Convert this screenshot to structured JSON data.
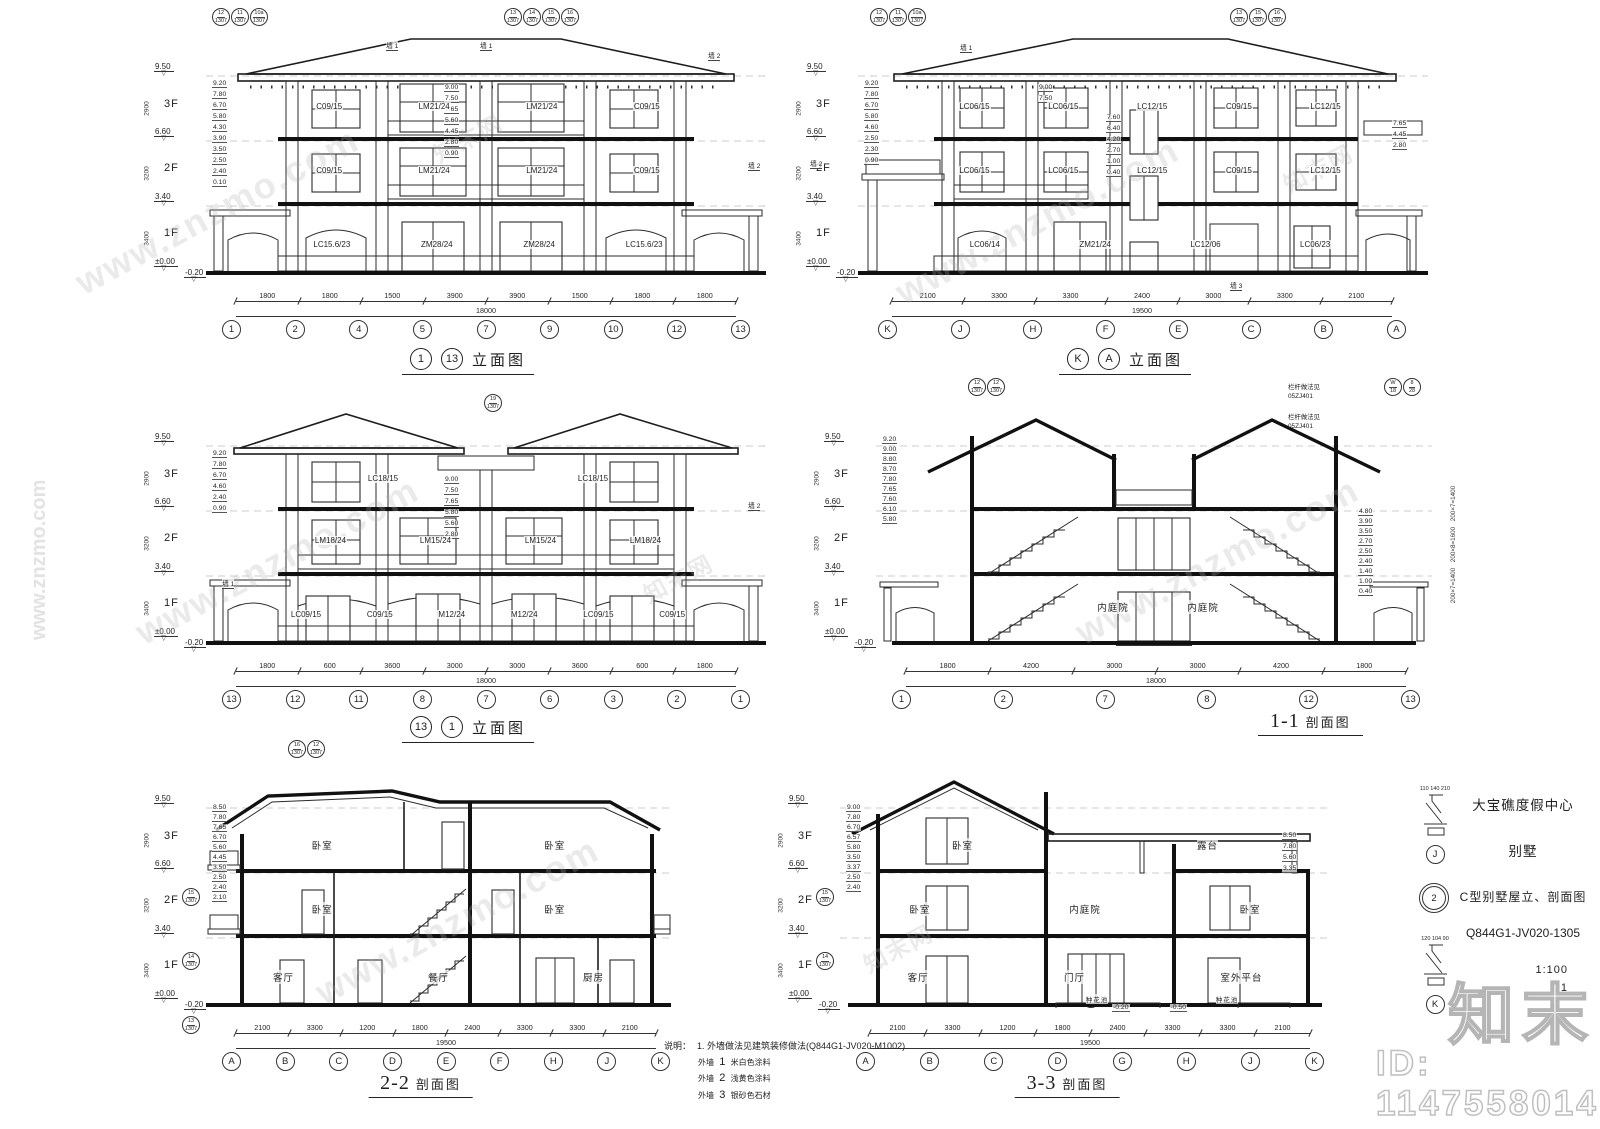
{
  "page": {
    "bg": "#ffffff",
    "ink": "#1f1f1f",
    "watermark": "www.znzmo.com",
    "watermark_cn": "知末网",
    "logo": "知末",
    "id_label": "ID: 1147558014"
  },
  "titleblock": {
    "project": "大宝礁度假中心",
    "building": "别墅",
    "drawing_title": "C型别墅屋立、剖面图",
    "drawing_no": "Q844G1-JV020-1305",
    "scale": "1:100",
    "sheet": "1",
    "details": [
      {
        "label": "J",
        "dims": "110 140 210"
      },
      {
        "label": "2",
        "dims": ""
      },
      {
        "label": "K",
        "dims": "120 104 90"
      }
    ]
  },
  "notes": {
    "heading": "说明：",
    "line1": "1.  外墙做法见建筑装修做法(Q844G1-JV020-M1002).",
    "items": [
      {
        "tag": "外墙",
        "num": "1",
        "desc": "米白色涂料"
      },
      {
        "tag": "外墙",
        "num": "2",
        "desc": "浅黄色涂料"
      },
      {
        "tag": "外墙",
        "num": "3",
        "desc": "银砂色石材"
      }
    ]
  },
  "common": {
    "floors": [
      "3F",
      "2F",
      "1F"
    ],
    "floor_heights": [
      "2900",
      "3200",
      "3400"
    ],
    "main_levels": [
      "9.50",
      "6.60",
      "3.40",
      "±0.00"
    ],
    "base_level": "-0.20"
  },
  "panels": {
    "p1": {
      "title": {
        "a": "1",
        "b": "13",
        "text": "立面图"
      },
      "callouts_left": [
        {
          "n": "12",
          "s": "1307"
        },
        {
          "n": "11",
          "s": "1307"
        },
        {
          "n": "10a",
          "s": "1307"
        }
      ],
      "callouts_right": [
        {
          "n": "13",
          "s": "1307"
        },
        {
          "n": "14",
          "s": "1307"
        },
        {
          "n": "15",
          "s": "1307"
        },
        {
          "n": "16",
          "s": "1307"
        }
      ],
      "wall_tags": [
        "墙 1",
        "墙 1",
        "墙 2",
        "墙 2"
      ],
      "inner_levels_left": [
        "9.20",
        "7.80",
        "6.70",
        "5.80",
        "4.30",
        "3.90",
        "3.50",
        "2.50",
        "2.40",
        "0.10"
      ],
      "inner_levels_mid": [
        "9.00",
        "7.50",
        "7.65",
        "5.60",
        "4.45",
        "2.80",
        "0.90"
      ],
      "labels_3f": [
        "C09/15",
        "LM21/24",
        "LM21/24",
        "C09/15"
      ],
      "labels_2f": [
        "C09/15",
        "LM21/24",
        "LM21/24",
        "C09/15"
      ],
      "labels_1f": [
        "LC15.6/23",
        "ZM28/24",
        "ZM28/24",
        "LC15.6/23"
      ],
      "axes": [
        "1",
        "2",
        "4",
        "5",
        "7",
        "9",
        "10",
        "12",
        "13"
      ],
      "dims": [
        "1800",
        "1800",
        "1500",
        "3900",
        "3900",
        "1500",
        "1800",
        "1800"
      ],
      "total": "18000"
    },
    "p2": {
      "title": {
        "a": "K",
        "b": "A",
        "text": "立面图"
      },
      "callouts_left": [
        {
          "n": "12",
          "s": "1307"
        },
        {
          "n": "11",
          "s": "1307"
        },
        {
          "n": "10a",
          "s": "1307"
        }
      ],
      "callouts_right": [
        {
          "n": "13",
          "s": "1307"
        },
        {
          "n": "15",
          "s": "1307"
        },
        {
          "n": "16",
          "s": "1307"
        }
      ],
      "wall_tags": [
        "墙 1",
        "墙 2",
        "墙 3"
      ],
      "inner_levels_left": [
        "9.20",
        "7.80",
        "6.70",
        "5.80",
        "4.60",
        "2.50",
        "2.30",
        "0.90"
      ],
      "inner_levels_mid": [
        "9.00",
        "7.50"
      ],
      "inner_levels_right": [
        "7.65",
        "4.45",
        "2.80"
      ],
      "stair_levels": [
        "7.60",
        "6.40",
        "4.20",
        "2.70",
        "1.00",
        "0.40"
      ],
      "labels_3f": [
        "LC06/15",
        "LC06/15",
        "LC12/15",
        "C09/15",
        "LC12/15"
      ],
      "labels_2f": [
        "LC06/15",
        "LC06/15",
        "LC12/15",
        "C09/15",
        "LC12/15"
      ],
      "labels_1f": [
        "LC06/14",
        "ZM21/24",
        "LC12/06",
        "LC06/23"
      ],
      "axes": [
        "K",
        "J",
        "H",
        "F",
        "E",
        "C",
        "B",
        "A"
      ],
      "dims": [
        "2100",
        "3300",
        "3300",
        "2400",
        "3000",
        "3300",
        "2100"
      ],
      "total": "19500"
    },
    "p3": {
      "title": {
        "a": "13",
        "b": "1",
        "text": "立面图"
      },
      "callouts": [
        {
          "n": "19",
          "s": "1307"
        }
      ],
      "wall_tags": [
        "墙 1",
        "墙 2"
      ],
      "inner_levels_left": [
        "9.20",
        "7.80",
        "6.70",
        "4.60",
        "2.40",
        "0.90"
      ],
      "inner_levels_mid": [
        "9.00",
        "7.50",
        "7.65",
        "5.80",
        "5.60",
        "2.80"
      ],
      "labels_3f": [
        "LC18/15",
        "LC18/15"
      ],
      "labels_2f": [
        "LM18/24",
        "LM15/24",
        "LM15/24",
        "LM18/24"
      ],
      "labels_1f": [
        "LC09/15",
        "C09/15",
        "M12/24",
        "M12/24",
        "LC09/15",
        "C09/15"
      ],
      "axes": [
        "13",
        "12",
        "11",
        "8",
        "7",
        "6",
        "3",
        "2",
        "1"
      ],
      "dims": [
        "1800",
        "600",
        "3600",
        "3000",
        "3000",
        "3600",
        "600",
        "1800"
      ],
      "total": "18000"
    },
    "p4": {
      "title": {
        "num": "1-1",
        "text": "剖面图"
      },
      "callouts": [
        {
          "n": "12",
          "s": "1307"
        },
        {
          "n": "12",
          "s": "1307"
        }
      ],
      "callouts_wh": [
        {
          "n": "W",
          "s": "18"
        },
        {
          "n": "8",
          "s": "28"
        }
      ],
      "railing_note": "栏杆做法见",
      "railing_ref": "05ZJ401",
      "rooms": [
        "内庭院",
        "内庭院"
      ],
      "inner_levels_left": [
        "9.20",
        "9.00",
        "8.80",
        "8.70",
        "7.80",
        "7.65",
        "7.60",
        "6.10",
        "5.80"
      ],
      "inner_levels_right": [
        "4.80",
        "3.90",
        "3.50",
        "2.70",
        "2.50",
        "2.40",
        "1.40",
        "1.00",
        "0.40"
      ],
      "stair_dims": [
        "200×7=1400",
        "200×8=1600",
        "200×7=1400"
      ],
      "axes": [
        "1",
        "2",
        "7",
        "8",
        "12",
        "13"
      ],
      "dims": [
        "1800",
        "4200",
        "3000",
        "3000",
        "4200",
        "1800"
      ],
      "total": "18000"
    },
    "p5": {
      "title": {
        "num": "2-2",
        "text": "剖面图"
      },
      "callouts_top": [
        {
          "n": "16",
          "s": "1307"
        },
        {
          "n": "12",
          "s": "1307"
        }
      ],
      "callouts_left": [
        {
          "n": "15",
          "s": "1307"
        },
        {
          "n": "14",
          "s": "1307"
        },
        {
          "n": "13",
          "s": "1307"
        }
      ],
      "rooms_3f": [
        "卧室",
        "卧室"
      ],
      "rooms_2f": [
        "卧室",
        "卧室"
      ],
      "rooms_1f": [
        "客厅",
        "餐厅",
        "厨房"
      ],
      "inner_levels": [
        "8.50",
        "7.80",
        "7.65",
        "6.70",
        "5.60",
        "4.45",
        "3.50",
        "2.50",
        "2.40",
        "2.10"
      ],
      "axes": [
        "A",
        "B",
        "C",
        "D",
        "E",
        "F",
        "H",
        "J",
        "K"
      ],
      "dims": [
        "2100",
        "3300",
        "1200",
        "1800",
        "2400",
        "3300",
        "3300",
        "2100"
      ],
      "total": "19500"
    },
    "p6": {
      "title": {
        "num": "3-3",
        "text": "剖面图"
      },
      "callouts_left": [
        {
          "n": "15",
          "s": "1307"
        },
        {
          "n": "14",
          "s": "1307"
        }
      ],
      "callout_center": [
        {
          "n": "20",
          "s": "1307"
        }
      ],
      "rooms_3f": [
        "卧室",
        "露台"
      ],
      "rooms_2f": [
        "卧室",
        "内庭院",
        "卧室"
      ],
      "rooms_1f": [
        "客厅",
        "门厅",
        "室外平台"
      ],
      "planters": [
        "种花池",
        "种花池"
      ],
      "inner_levels_left": [
        "9.00",
        "7.80",
        "6.70",
        "6.57",
        "5.80",
        "3.50",
        "3.37",
        "2.50",
        "2.40"
      ],
      "inner_levels_right": [
        "8.50",
        "7.80",
        "5.60",
        "3.35"
      ],
      "base_levels": [
        "-0.20",
        "-0.50"
      ],
      "axes": [
        "A",
        "B",
        "C",
        "D",
        "G",
        "H",
        "J",
        "K"
      ],
      "dims": [
        "2100",
        "3300",
        "1200",
        "1800",
        "2400",
        "3300",
        "3300",
        "2100"
      ],
      "total": "19500"
    }
  }
}
